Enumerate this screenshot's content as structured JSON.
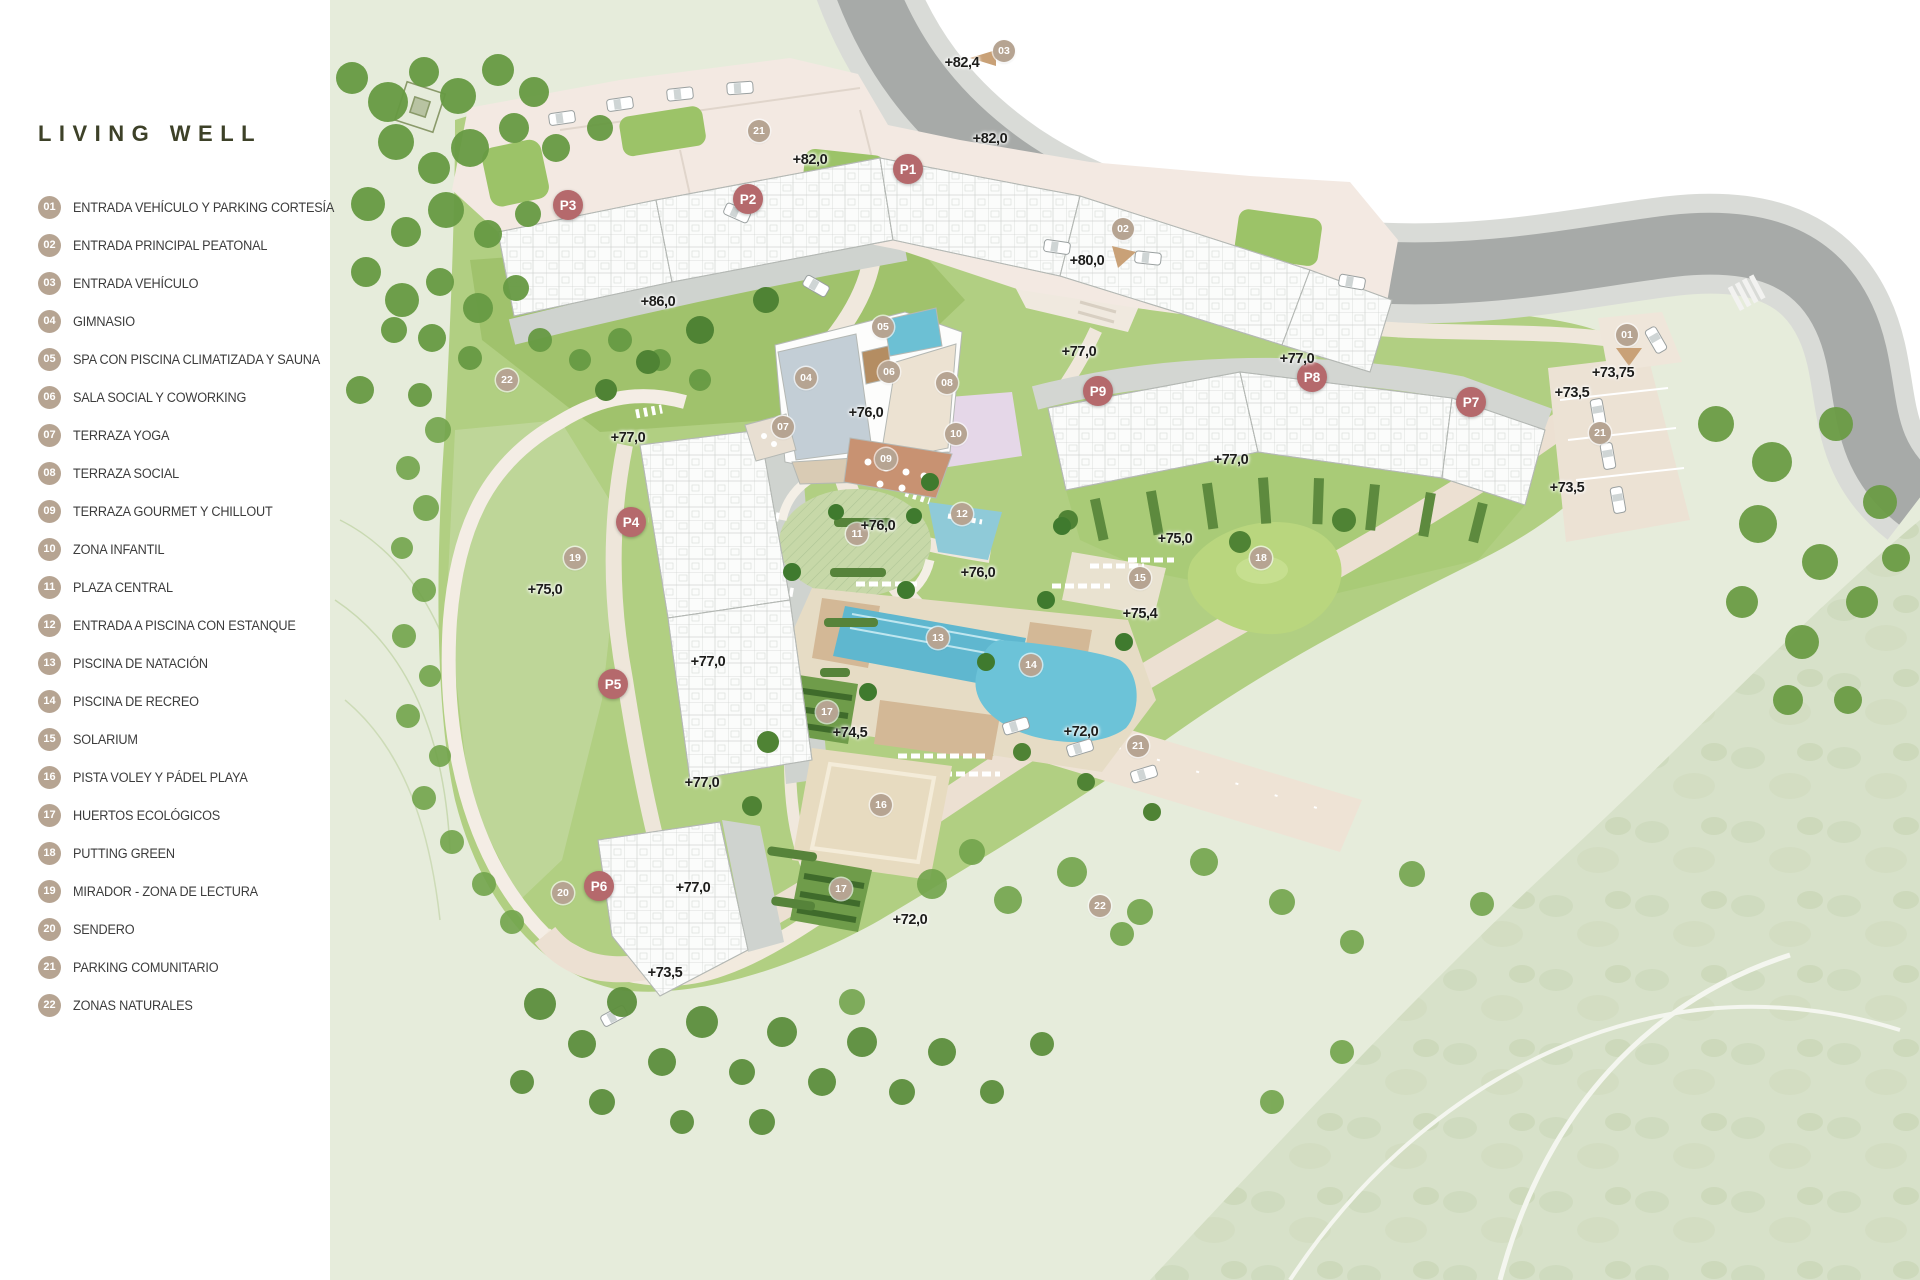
{
  "title": "LIVING WELL",
  "legend": {
    "items": [
      {
        "num": "01",
        "label": "ENTRADA VEHÍCULO Y PARKING CORTESÍA"
      },
      {
        "num": "02",
        "label": "ENTRADA PRINCIPAL PEATONAL"
      },
      {
        "num": "03",
        "label": "ENTRADA VEHÍCULO"
      },
      {
        "num": "04",
        "label": "GIMNASIO"
      },
      {
        "num": "05",
        "label": "SPA CON PISCINA CLIMATIZADA Y SAUNA"
      },
      {
        "num": "06",
        "label": "SALA SOCIAL Y COWORKING"
      },
      {
        "num": "07",
        "label": "TERRAZA YOGA"
      },
      {
        "num": "08",
        "label": "TERRAZA SOCIAL"
      },
      {
        "num": "09",
        "label": "TERRAZA GOURMET Y CHILLOUT"
      },
      {
        "num": "10",
        "label": "ZONA INFANTIL"
      },
      {
        "num": "11",
        "label": "PLAZA CENTRAL"
      },
      {
        "num": "12",
        "label": "ENTRADA A PISCINA CON ESTANQUE"
      },
      {
        "num": "13",
        "label": "PISCINA DE NATACIÓN"
      },
      {
        "num": "14",
        "label": "PISCINA DE RECREO"
      },
      {
        "num": "15",
        "label": "SOLARIUM"
      },
      {
        "num": "16",
        "label": "PISTA VOLEY Y PÁDEL PLAYA"
      },
      {
        "num": "17",
        "label": "HUERTOS ECOLÓGICOS"
      },
      {
        "num": "18",
        "label": "PUTTING GREEN"
      },
      {
        "num": "19",
        "label": "MIRADOR - ZONA DE LECTURA"
      },
      {
        "num": "20",
        "label": "SENDERO"
      },
      {
        "num": "21",
        "label": "PARKING COMUNITARIO"
      },
      {
        "num": "22",
        "label": "ZONAS NATURALES"
      }
    ]
  },
  "map": {
    "colors": {
      "phase_marker": "#b5696c",
      "amenity_marker": "#b6a492",
      "title_text": "#3d4128",
      "pool_water": "#62b9d0",
      "lawn_green": "#aecd7d",
      "road_asphalt": "#a7aaa8",
      "path_cream": "#f0e8df"
    },
    "phase_markers": [
      {
        "label": "P1",
        "x": 908,
        "y": 169
      },
      {
        "label": "P2",
        "x": 748,
        "y": 199
      },
      {
        "label": "P3",
        "x": 568,
        "y": 205
      },
      {
        "label": "P4",
        "x": 631,
        "y": 522
      },
      {
        "label": "P5",
        "x": 613,
        "y": 684
      },
      {
        "label": "P6",
        "x": 599,
        "y": 886
      },
      {
        "label": "P7",
        "x": 1471,
        "y": 402
      },
      {
        "label": "P8",
        "x": 1312,
        "y": 377
      },
      {
        "label": "P9",
        "x": 1098,
        "y": 391
      }
    ],
    "amenity_markers": [
      {
        "num": "01",
        "x": 1627,
        "y": 335
      },
      {
        "num": "02",
        "x": 1123,
        "y": 229
      },
      {
        "num": "03",
        "x": 1004,
        "y": 51
      },
      {
        "num": "04",
        "x": 806,
        "y": 378
      },
      {
        "num": "05",
        "x": 883,
        "y": 327
      },
      {
        "num": "06",
        "x": 889,
        "y": 372
      },
      {
        "num": "07",
        "x": 783,
        "y": 427
      },
      {
        "num": "08",
        "x": 947,
        "y": 383
      },
      {
        "num": "09",
        "x": 886,
        "y": 459
      },
      {
        "num": "10",
        "x": 956,
        "y": 434
      },
      {
        "num": "11",
        "x": 857,
        "y": 534
      },
      {
        "num": "12",
        "x": 962,
        "y": 514
      },
      {
        "num": "13",
        "x": 938,
        "y": 638
      },
      {
        "num": "14",
        "x": 1031,
        "y": 665
      },
      {
        "num": "15",
        "x": 1140,
        "y": 578
      },
      {
        "num": "16",
        "x": 881,
        "y": 805
      },
      {
        "num": "17",
        "x": 827,
        "y": 712
      },
      {
        "num": "17",
        "x": 841,
        "y": 889
      },
      {
        "num": "18",
        "x": 1261,
        "y": 558
      },
      {
        "num": "19",
        "x": 575,
        "y": 558
      },
      {
        "num": "20",
        "x": 563,
        "y": 893
      },
      {
        "num": "21",
        "x": 759,
        "y": 131
      },
      {
        "num": "21",
        "x": 1600,
        "y": 433
      },
      {
        "num": "21",
        "x": 1138,
        "y": 746
      },
      {
        "num": "22",
        "x": 507,
        "y": 380
      },
      {
        "num": "22",
        "x": 1100,
        "y": 906
      }
    ],
    "elevation_labels": [
      {
        "text": "+82,4",
        "x": 962,
        "y": 63
      },
      {
        "text": "+82,0",
        "x": 810,
        "y": 160
      },
      {
        "text": "+82,0",
        "x": 990,
        "y": 139
      },
      {
        "text": "+86,0",
        "x": 658,
        "y": 302
      },
      {
        "text": "+80,0",
        "x": 1087,
        "y": 261
      },
      {
        "text": "+77,0",
        "x": 1079,
        "y": 352
      },
      {
        "text": "+77,0",
        "x": 1297,
        "y": 359
      },
      {
        "text": "+77,0",
        "x": 1231,
        "y": 460
      },
      {
        "text": "+76,0",
        "x": 866,
        "y": 413
      },
      {
        "text": "+77,0",
        "x": 628,
        "y": 438
      },
      {
        "text": "+76,0",
        "x": 878,
        "y": 526
      },
      {
        "text": "+75,0",
        "x": 545,
        "y": 590
      },
      {
        "text": "+76,0",
        "x": 978,
        "y": 573
      },
      {
        "text": "+75,0",
        "x": 1175,
        "y": 539
      },
      {
        "text": "+75,4",
        "x": 1140,
        "y": 614
      },
      {
        "text": "+73,75",
        "x": 1613,
        "y": 373
      },
      {
        "text": "+73,5",
        "x": 1572,
        "y": 393
      },
      {
        "text": "+73,5",
        "x": 1567,
        "y": 488
      },
      {
        "text": "+77,0",
        "x": 708,
        "y": 662
      },
      {
        "text": "+77,0",
        "x": 702,
        "y": 783
      },
      {
        "text": "+74,5",
        "x": 850,
        "y": 733
      },
      {
        "text": "+72,0",
        "x": 1081,
        "y": 732
      },
      {
        "text": "+77,0",
        "x": 693,
        "y": 888
      },
      {
        "text": "+72,0",
        "x": 910,
        "y": 920
      },
      {
        "text": "+73,5",
        "x": 665,
        "y": 973
      }
    ]
  }
}
